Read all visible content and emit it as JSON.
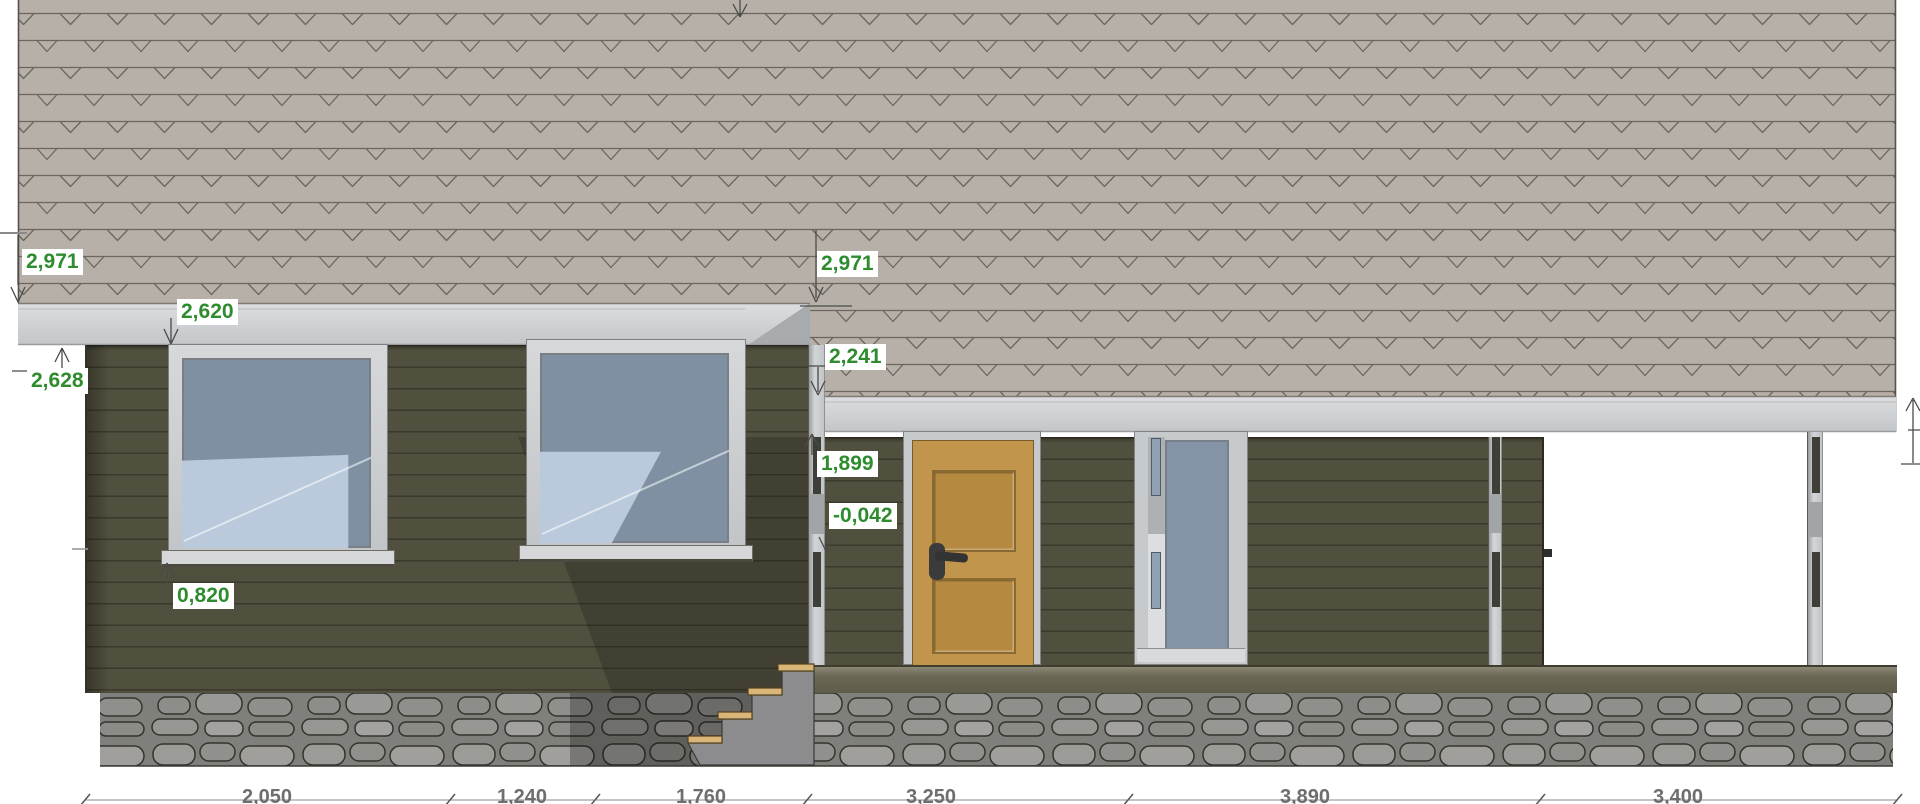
{
  "drawing": {
    "palette": {
      "dimension_green": "#2e8b2e",
      "dimension_gray": "#6e6e6e",
      "roof_shingle": "#b7b0a8",
      "fascia": "#ced1d3",
      "siding": "#514f3e",
      "door_wood": "#c2954d",
      "glass_dark": "#7e90a2",
      "glass_light": "#bac9db",
      "stone": "#8d8d8a",
      "deck": "#6b6857",
      "stair_tread_wood": "#d9b577"
    },
    "elevation_marks": {
      "eave_left_upper": "2,971",
      "fascia_left_lower": "2,628",
      "soffit_left": "2,620",
      "eave_mid_upper": "2,971",
      "eave_mid_lower": "2,241",
      "porch_beam_bottom": "1,899",
      "window_sill": "0,820",
      "porch_floor": "-0,042"
    },
    "width_dims": [
      "2,050",
      "1,240",
      "1,760",
      "3,250",
      "3,890",
      "3,400"
    ]
  }
}
